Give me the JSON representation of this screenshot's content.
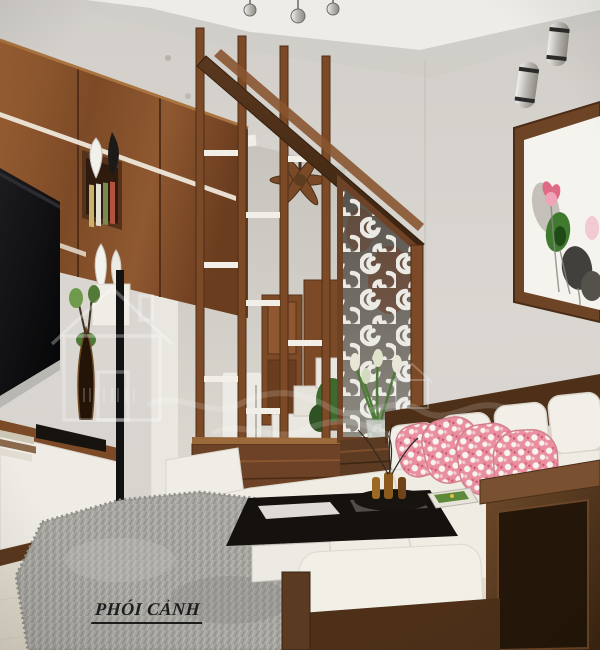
{
  "image": {
    "kind": "3D interior rendering of a narrow living room",
    "width_px": 600,
    "height_px": 650
  },
  "caption": {
    "text": "PHÓI CẢNH"
  },
  "watermark": {
    "logo": "house-outline",
    "style": "faint white overlay logo and cursive squiggle"
  },
  "palette": {
    "wall": "#d8d4cf",
    "ceiling_band": "#eeece8",
    "wood_mid": "#8a5530",
    "wood_dark": "#46301c",
    "wood_light": "#a2693c",
    "sofa_fabric": "#f2efe8",
    "pillow_pink": "#e98fa0",
    "rug_gray": "#a6a5a0",
    "floor_cream": "#e9e4d8",
    "tv_black": "#0d0d0f",
    "swirl_panel_white": "#eceae4",
    "plant_green": "#3f6a2e",
    "caption_ink": "#1d1d1d"
  },
  "scene": {
    "objects": [
      {
        "name": "track-light",
        "desc": "3 chrome ceiling spots, top center"
      },
      {
        "name": "tv-wall-unit",
        "desc": "walnut cabinets, LED strips, book niches, white and black vases"
      },
      {
        "name": "television",
        "desc": "black flat TV on left wall"
      },
      {
        "name": "floor-lamp",
        "desc": "black slim pole lamp"
      },
      {
        "name": "arched-doorway",
        "desc": "white classical arch with pilaster"
      },
      {
        "name": "ceiling-fan",
        "desc": "wooden blade fan in hallway"
      },
      {
        "name": "staircase",
        "desc": "white steps rising to the right behind partition"
      },
      {
        "name": "wood-partition",
        "desc": "vertical wooden slats with small white shelves under stair beam"
      },
      {
        "name": "cnc-swirl-panel",
        "desc": "white laser-cut scroll screen in wood frame"
      },
      {
        "name": "flower-vase",
        "desc": "tulip bouquet in front of swirl panel"
      },
      {
        "name": "wall-sconces",
        "desc": "two cylindrical up-down lights, top right wall"
      },
      {
        "name": "wall-painting",
        "desc": "framed lotus ink artwork on right wall"
      },
      {
        "name": "sofa",
        "desc": "L-shaped cream fabric sofa with dark wood frame"
      },
      {
        "name": "throw-pillows",
        "desc": "pink floral chintz cushions"
      },
      {
        "name": "coffee-table",
        "desc": "black glass top on white base, tray with bottles and branches, magazine"
      },
      {
        "name": "ottoman",
        "desc": "white cushioned wooden stool"
      },
      {
        "name": "area-rug",
        "desc": "gray shaggy rug"
      }
    ]
  }
}
